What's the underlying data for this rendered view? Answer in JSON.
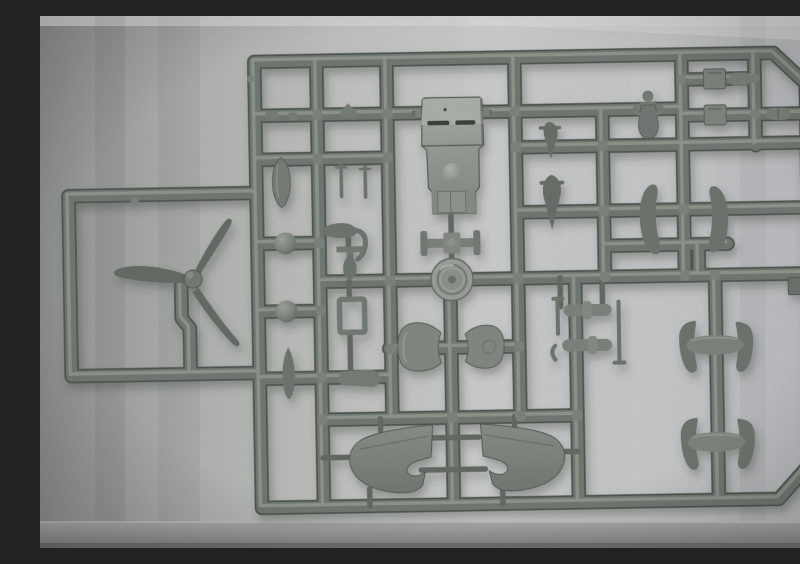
{
  "scene": {
    "type": "photograph",
    "aria": "Photograph of a grey injection-moulded model kit sprue with aircraft parts on light grey paper",
    "subject": "Model kit sprue with grey plastic aircraft parts",
    "background": "light grey paper"
  },
  "palette": {
    "plastic": "#7b837b",
    "plastic_dark": "#575e57",
    "plastic_light": "#9aa199",
    "plastic_face": "#aeb4ac",
    "paper_light": "#d7d8da",
    "paper_dark": "#9c9e9b",
    "shadow": "#394039"
  },
  "parts": [
    {
      "label": "Three-blade propeller"
    },
    {
      "label": "Fuselage / engine cowling block"
    },
    {
      "label": "Cowl ring disc"
    },
    {
      "label": "Tailplane cross piece"
    },
    {
      "label": "Drop tank"
    },
    {
      "label": "Spherical wheel half (upper)"
    },
    {
      "label": "Spherical wheel half (lower)"
    },
    {
      "label": "Vertical blade part"
    },
    {
      "label": "Antenna masts"
    },
    {
      "label": "Small bomb"
    },
    {
      "label": "Exhaust elbow"
    },
    {
      "label": "Tee fitting"
    },
    {
      "label": "Mini bomb"
    },
    {
      "label": "Rectangular frame part"
    },
    {
      "label": "Capsule part"
    },
    {
      "label": "Pilot figure"
    },
    {
      "label": "Engine block (upper)"
    },
    {
      "label": "Engine block (lower)"
    },
    {
      "label": "Small bullet part"
    },
    {
      "label": "Cylinder part"
    },
    {
      "label": "Spinner cone (small)"
    },
    {
      "label": "Spinner cone (large)"
    },
    {
      "label": "Cowl flap half (left)"
    },
    {
      "label": "Cowl flap half (right)"
    },
    {
      "label": "Landing gear strut set"
    },
    {
      "label": "Spat dome half (left)"
    },
    {
      "label": "Spat dome half (right)"
    },
    {
      "label": "Stabiliser and spat set (upper)"
    },
    {
      "label": "Stabiliser and spat set (lower)"
    },
    {
      "label": "Port wing half"
    },
    {
      "label": "Starboard wing half"
    },
    {
      "label": "Sprue runner frame"
    },
    {
      "label": "Moulding tab"
    },
    {
      "label": "Sprue fragments"
    }
  ]
}
